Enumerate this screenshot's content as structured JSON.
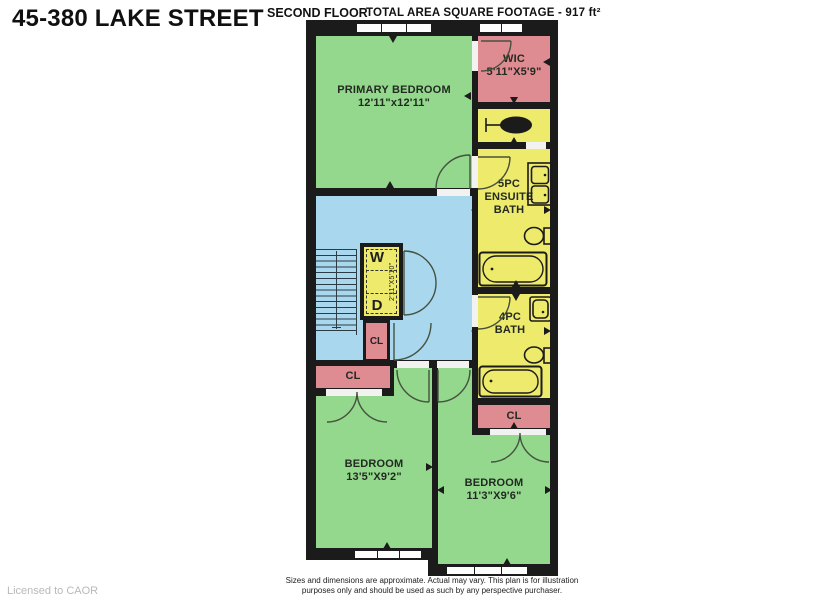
{
  "header": {
    "title": "45-380 LAKE STREET",
    "floor_label": "SECOND FLOOR",
    "area_label": "TOTAL AREA SQUARE FOOTAGE -  917 ft²"
  },
  "rooms": {
    "primary_bedroom": {
      "name": "PRIMARY BEDROOM",
      "dims": "12'11\"x12'11\""
    },
    "wic": {
      "name": "WIC",
      "dims": "5'11\"X5'9\""
    },
    "ensuite_bath": {
      "line1": "5PC",
      "line2": "ENSUITE",
      "line3": "BATH"
    },
    "bath": {
      "line1": "4PC",
      "line2": "BATH"
    },
    "bedroom_left": {
      "name": "BEDROOM",
      "dims": "13'5\"X9'2\""
    },
    "bedroom_right": {
      "name": "BEDROOM",
      "dims": "11'3\"X9'6\""
    },
    "closet_hall": {
      "label": "CL"
    },
    "closet_bedroom_left": {
      "label": "CL"
    },
    "closet_bedroom_right": {
      "label": "CL"
    },
    "laundry": {
      "washer_label": "W",
      "dryer_label": "D",
      "dims": "2'11\"X5'10\""
    }
  },
  "footer": {
    "license": "Licensed to CAOR",
    "disclaimer_line1": "Sizes and dimensions are approximate. Actual may vary. This plan is for illustration",
    "disclaimer_line2": "purposes only and should be used as such by any perspective purchaser."
  },
  "icons": {
    "stairs": "stairs-icon",
    "door": "door-swing-arc-icon",
    "bathtub": "bathtub-icon",
    "toilet": "toilet-icon",
    "sink": "sink-icon",
    "double_sink": "double-sink-vanity-icon",
    "laundry_fixture": "laundry-fixture-icon",
    "window": "window-marker-icon",
    "dimension_tick": "dimension-tick-icon"
  },
  "colors": {
    "green": "#93d88c",
    "blue": "#a9d8ee",
    "yellow": "#eeea6c",
    "pink": "#df8b92",
    "wall": "#1b1b1b"
  }
}
